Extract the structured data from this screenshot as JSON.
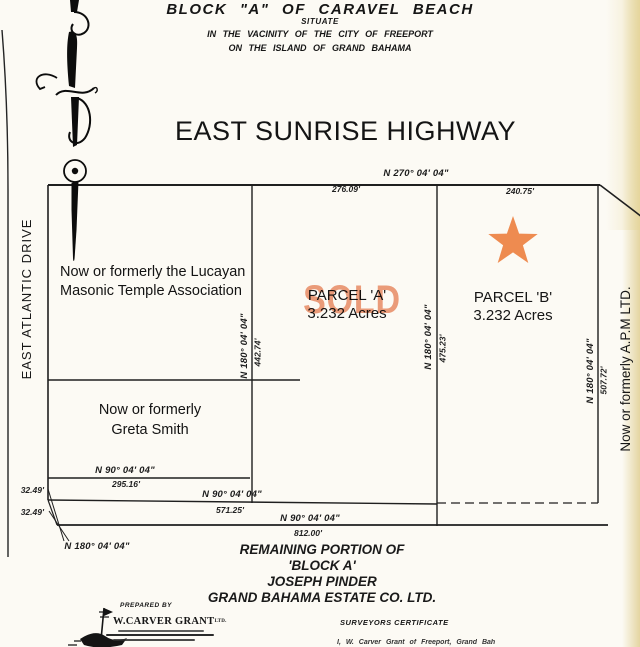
{
  "document": {
    "title": "BLOCK \"A\" OF CARAVEL BEACH",
    "subtitle1": "SITUATE",
    "subtitle2": "IN THE VACINITY OF THE CITY OF FREEPORT",
    "subtitle3": "ON THE ISLAND OF GRAND BAHAMA"
  },
  "roads": {
    "north_road": "EAST SUNRISE HIGHWAY",
    "west_road": "EAST ATLANTIC DRIVE"
  },
  "parcels": {
    "masonic_line1": "Now or formerly the Lucayan",
    "masonic_line2": "Masonic Temple Association",
    "greta_line1": "Now or formerly",
    "greta_line2": "Greta Smith",
    "parcel_a_name": "PARCEL 'A'",
    "parcel_a_area": "3.232 Acres",
    "parcel_a_stamp": "SOLD",
    "parcel_b_name": "PARCEL 'B'",
    "parcel_b_area": "3.232 Acres",
    "east_owner": "Now or formerly  A.P.M LTD."
  },
  "dimensions": {
    "top_bearing": "N 270° 04' 04\"",
    "top_dist_a": "276.09'",
    "top_dist_b": "240.75'",
    "div_masonic_bearing": "N 180° 04' 04\"",
    "div_masonic_dist": "442.74'",
    "div_ab_bearing": "N 180° 04' 04\"",
    "div_ab_dist": "475.23'",
    "east_bearing": "N 180° 04' 04\"",
    "east_dist": "507.72'",
    "greta_bearing": "N 90° 04' 04\"",
    "greta_dist": "295.16'",
    "mid_bearing": "N 90° 04' 04\"",
    "mid_dist": "571.25'",
    "south_bearing": "N 90° 04' 04\"",
    "south_dist": "812.00'",
    "offset_a": "32.49'",
    "offset_b": "32.49'",
    "offset_bearing": "N 180° 04' 04\""
  },
  "remaining": {
    "line1": "REMAINING PORTION OF",
    "line2": "'BLOCK A'",
    "line3": "JOSEPH PINDER",
    "line4": "GRAND BAHAMA ESTATE CO. LTD."
  },
  "footer": {
    "prepared_by": "PREPARED BY",
    "surveyor_name": "W.CARVER GRANT",
    "surveyor_suffix": "LTD.",
    "certificate_title": "SURVEYORS CERTIFICATE",
    "certificate_text": "I, W. Carver Grant of Freeport, Grand Bah"
  },
  "colors": {
    "star": "#ee8b50",
    "sold_stamp": "#e8825a",
    "line": "#1f1f1f",
    "paper": "#fcfaf4"
  }
}
